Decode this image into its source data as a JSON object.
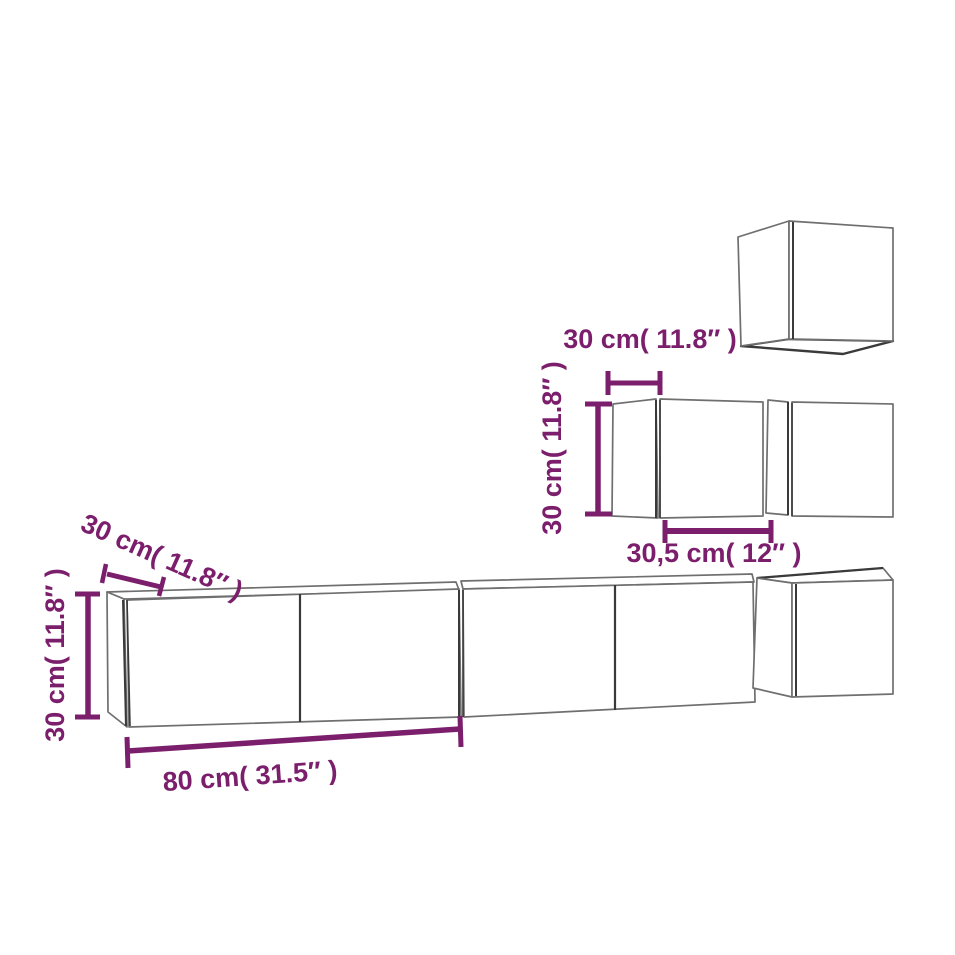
{
  "colors": {
    "dimension_purple": "#7B1E6C",
    "cabinet_outline": "#6F6F6F",
    "cabinet_edge_dark": "#3A3A3A",
    "background": "#FFFFFF"
  },
  "annotations": {
    "top_cube_depth": "30 cm( 11.8″ )",
    "mid_cabinet_height": "30 cm( 11.8″ )",
    "mid_cabinet_width": "30,5 cm( 12″ )",
    "long_cabinet_depth": "30 cm( 11.8″ )",
    "long_cabinet_height": "30 cm( 11.8″ )",
    "long_cabinet_width": "80 cm( 31.5″ )"
  }
}
